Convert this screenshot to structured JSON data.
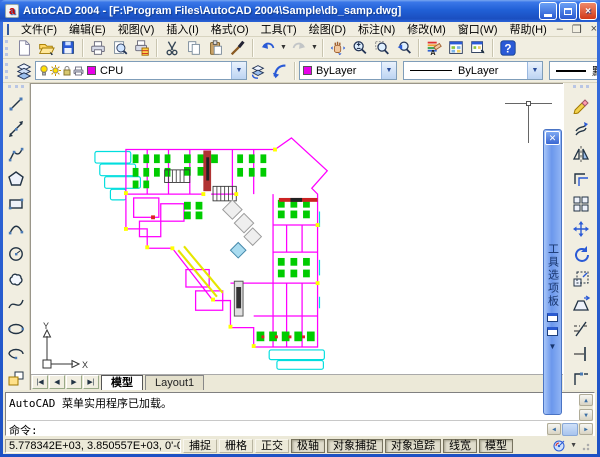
{
  "window": {
    "title": "AutoCAD 2004 - [F:\\Program Files\\AutoCAD 2004\\Sample\\db_samp.dwg]",
    "app_icon_letter": "a"
  },
  "menu": {
    "items": [
      "文件(F)",
      "编辑(E)",
      "视图(V)",
      "插入(I)",
      "格式(O)",
      "工具(T)",
      "绘图(D)",
      "标注(N)",
      "修改(M)",
      "窗口(W)",
      "帮助(H)"
    ]
  },
  "toolbars": {
    "standard_icons": [
      "qnew",
      "open",
      "save",
      "plot",
      "plot-preview",
      "publish",
      "cut",
      "copy-clip",
      "paste-clip",
      "match-properties",
      "undo",
      "redo",
      "pan-realtime",
      "zoom-realtime",
      "zoom-window",
      "zoom-previous",
      "properties",
      "design-center",
      "tool-palettes",
      "help"
    ],
    "layers": {
      "layer_value": "CPU",
      "icons": [
        "layer-properties-manager",
        "layer-previous",
        "make-object-layer-current"
      ]
    },
    "properties_bar": {
      "color_value": "ByLayer",
      "linetype_value": "ByLayer",
      "lineweight_value": "默认"
    },
    "draw_icons": [
      "line",
      "construction-line",
      "polyline",
      "polygon",
      "rectangle",
      "arc",
      "circle",
      "revision-cloud",
      "spline",
      "ellipse",
      "ellipse-arc",
      "insert-block"
    ],
    "modify_icons": [
      "erase",
      "copy-object",
      "mirror",
      "offset",
      "array",
      "move",
      "rotate",
      "scale",
      "stretch",
      "trim",
      "extend",
      "break"
    ]
  },
  "tool_palettes": {
    "title": "工具选项板"
  },
  "canvas": {
    "ucs_x": "X",
    "ucs_y": "Y"
  },
  "tabs": {
    "model": "模型",
    "layout1": "Layout1"
  },
  "command": {
    "history": "AutoCAD 菜单实用程序已加载。",
    "prompt": "命令:"
  },
  "status": {
    "coordinates": "5.778342E+03, 3.850557E+03, 0'-0\"",
    "toggles": [
      {
        "label": "捕捉",
        "on": false
      },
      {
        "label": "栅格",
        "on": false
      },
      {
        "label": "正交",
        "on": false
      },
      {
        "label": "极轴",
        "on": true
      },
      {
        "label": "对象捕捉",
        "on": true
      },
      {
        "label": "对象追踪",
        "on": true
      },
      {
        "label": "线宽",
        "on": true
      },
      {
        "label": "模型",
        "on": true
      }
    ]
  },
  "colors": {
    "titlebar": "#2160d6",
    "toolbar_bg": "#f1eee1",
    "canvas_bg": "#ffffff",
    "plan_magenta": "#ff00ff",
    "plan_cyan": "#00dede",
    "plan_green": "#00cc00",
    "plan_yellow": "#e6e600",
    "palette_strip": "#6b97ec"
  }
}
